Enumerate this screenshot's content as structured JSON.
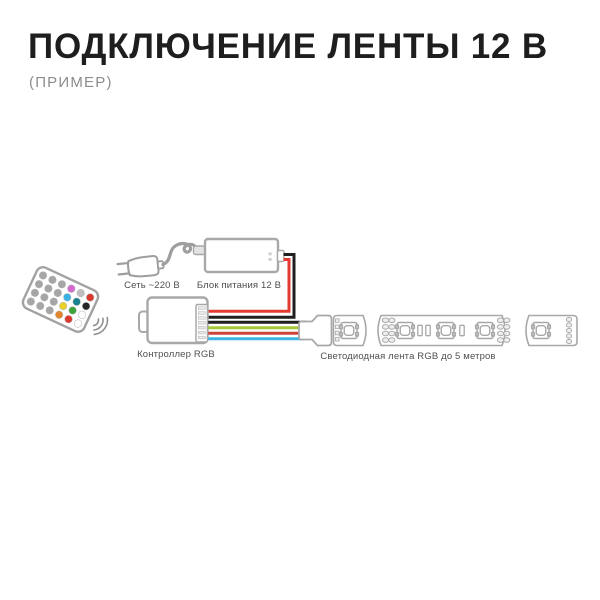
{
  "header": {
    "title": "ПОДКЛЮЧЕНИЕ ЛЕНТЫ 12 В",
    "subtitle": "(ПРИМЕР)"
  },
  "diagram": {
    "labels": {
      "mains": "Сеть ~220 В",
      "psu": "Блок питания 12 В",
      "controller": "Контроллер RGB",
      "strip": "Светодиодная лента RGB до 5 метров"
    },
    "palette": {
      "outline": "#a8a8a8",
      "cable_gray": "#9e9e9e",
      "title_text": "#1e1e1e",
      "subtitle_text": "#8d8d8d",
      "label_text": "#4f4f4f",
      "power_red": "#e23b31",
      "power_black": "#1f1f1f",
      "strip_black": "#1f1f1f",
      "strip_green": "#a6c839",
      "strip_red": "#cc453b",
      "strip_blue": "#3cb4e4"
    },
    "remote": {
      "buttons": [
        "#a6a6a6",
        "#a6a6a6",
        "#a6a6a6",
        "#d36bce",
        "#bfbfbf",
        "#d93a30",
        "#a6a6a6",
        "#a6a6a6",
        "#a6a6a6",
        "#38b2e3",
        "#17818f",
        "#262626",
        "#a6a6a6",
        "#a6a6a6",
        "#a6a6a6",
        "#e9d229",
        "#3ea33a",
        "#ffffff",
        "#a6a6a6",
        "#a6a6a6",
        "#a6a6a6",
        "#e2862b",
        "#d93a30",
        "#ffffff"
      ]
    },
    "strip": {
      "led_count": 5,
      "segment_count": 3
    }
  }
}
